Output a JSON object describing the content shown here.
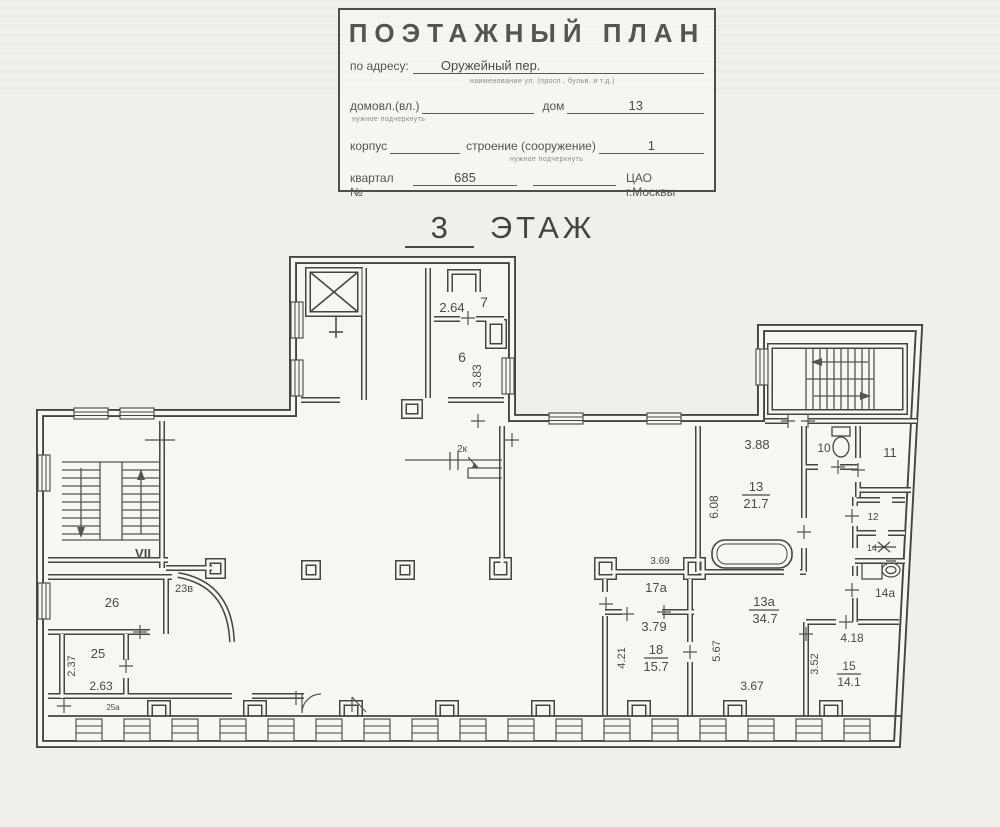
{
  "document": {
    "title_block": {
      "title": "ПОЭТАЖНЫЙ ПЛАН",
      "address_label": "по адресу:",
      "address_value": "Оружейный пер.",
      "address_hint": "наименование ул. (просп., бульв. и т.д.)",
      "ownership_label": "домовл.(вл.)",
      "ownership_hint": "нужное подчеркнуть",
      "house_label": "дом",
      "house_value": "13",
      "building_label": "корпус",
      "structure_label": "строение (сооружение)",
      "structure_hint": "нужное подчеркнуть",
      "structure_value": "1",
      "block_label": "квартал №",
      "block_value": "685",
      "district_value": "ЦАО г.Москвы"
    },
    "floor_heading": {
      "number": "3",
      "word": "ЭТАЖ"
    }
  },
  "plan": {
    "line_color": "#45443f",
    "stair_label_color": "#a8392f",
    "labels": {
      "vii": "VII",
      "r7": "7",
      "d264": "2.64",
      "r6": "6",
      "d383": "3.83",
      "k2": "2к",
      "d388": "3.88",
      "r13": "13",
      "a13": "21.7",
      "d608": "6.08",
      "r10": "10",
      "r11": "11",
      "r12": "12",
      "r14": "14",
      "r14a": "14а",
      "r23v": "23в",
      "r26": "26",
      "r25": "25",
      "d237": "2.37",
      "d263": "2.63",
      "r25a": "25а",
      "d369": "3.69",
      "r17a": "17а",
      "d379": "3.79",
      "r18": "18",
      "a18": "15.7",
      "d421": "4.21",
      "d567": "5.67",
      "r13a": "13а",
      "a13a": "34.7",
      "d418": "4.18",
      "d352": "3.52",
      "r15": "15",
      "a15": "14.1",
      "d367": "3.67"
    }
  }
}
